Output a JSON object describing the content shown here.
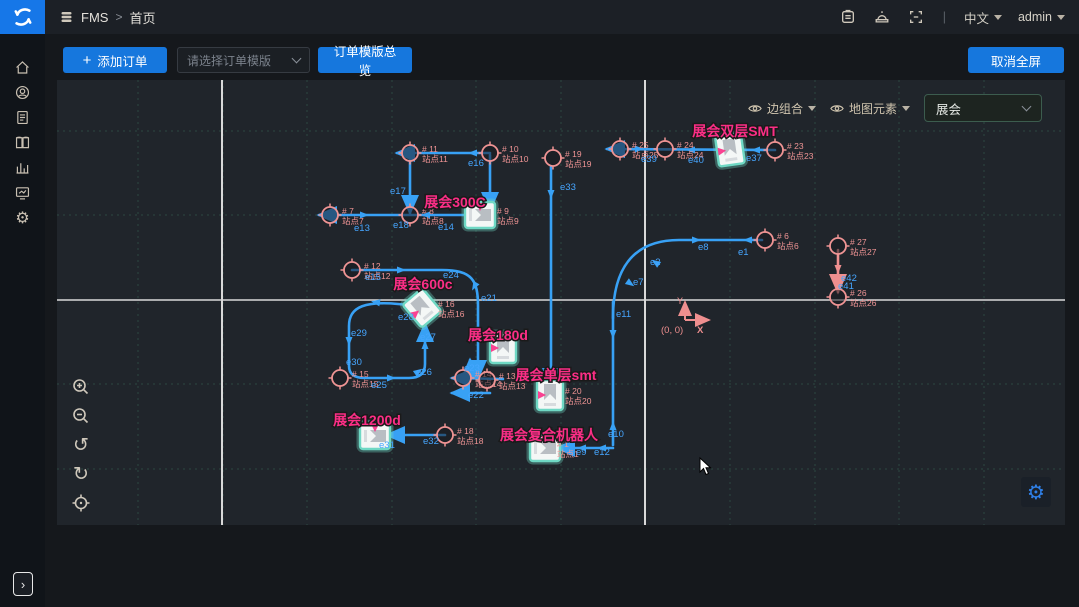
{
  "header": {
    "brand": "FMS",
    "breadcrumb_separator": ">",
    "page_title": "首页",
    "lang": "中文",
    "user": "admin"
  },
  "toolbar": {
    "add_order_icon": "+",
    "add_order": "添加订单",
    "template_placeholder": "请选择订单模版",
    "template_overview": "订单模版总览",
    "cancel_fullscreen": "取消全屏"
  },
  "sidebar_icons": [
    "home-icon",
    "robot-icon",
    "orders-icon",
    "map-icon",
    "stats-icon",
    "monitor-icon",
    "settings-icon"
  ],
  "header_icons": [
    "task-icon",
    "alarm-icon",
    "fullscreen-icon"
  ],
  "map": {
    "toolbar": {
      "edge_group": "边组合",
      "map_elements": "地图元素",
      "area_value": "展会"
    },
    "origin": {
      "label": "(0, 0)",
      "x_axis": "X",
      "y_axis": "Y"
    },
    "colors": {
      "edge": "#38a1f5",
      "edge_label": "#46a6ff",
      "station": "#ef9494",
      "area_label": "#fb2e86",
      "robot_stroke": "#6fd8c4",
      "pink_edge": "#ef8f8f",
      "grid": "#2b4740",
      "major": "#d9d9d9",
      "bg": "#20252b"
    },
    "grid": {
      "vx": [
        81,
        166,
        250,
        335,
        419,
        504,
        673,
        758,
        842,
        927
      ],
      "hy": [
        51,
        135,
        304,
        389
      ],
      "major_vx": [
        165,
        588
      ],
      "major_hy": [
        220
      ]
    },
    "paths": [
      {
        "d": "M433,73 L340,73",
        "end": true
      },
      {
        "d": "M353,73 L353,133",
        "end": true
      },
      {
        "d": "M433,75 L433,130",
        "end": true
      },
      {
        "d": "M423,135 L262,135",
        "end": true
      },
      {
        "d": "M718,70 L550,69",
        "end": true
      },
      {
        "d": "M494,86 L494,306",
        "end": true
      },
      {
        "d": "M556,222 L556,365",
        "end": false
      },
      {
        "d": "M556,238 C556,190 575,160 622,160 L705,160",
        "end": false
      },
      {
        "d": "M358,226 C305,218 292,228 292,246 L292,286 C292,296 300,298 308,298 L352,298 C364,298 368,292 368,284 L368,244",
        "end": true
      },
      {
        "d": "M295,190 L385,190 C415,190 421,200 421,226 L421,298",
        "end": true
      },
      {
        "d": "M446,299 L395,298",
        "end": true
      },
      {
        "d": "M433,313 L395,313",
        "end": true
      },
      {
        "d": "M413,298 L413,280",
        "end": true
      },
      {
        "d": "M388,355 L330,355",
        "end": true
      },
      {
        "d": "M556,368 L500,368",
        "end": true
      },
      {
        "d": "M781,170 L781,212",
        "end": true,
        "c": "pink"
      }
    ],
    "arrows": [
      {
        "x": 415,
        "y": 73,
        "r": 180
      },
      {
        "x": 308,
        "y": 135,
        "r": 0
      },
      {
        "x": 368,
        "y": 135,
        "r": 180
      },
      {
        "x": 583,
        "y": 69,
        "r": 0
      },
      {
        "x": 633,
        "y": 70,
        "r": 180
      },
      {
        "x": 698,
        "y": 70,
        "r": 180
      },
      {
        "x": 494,
        "y": 115,
        "r": 90
      },
      {
        "x": 556,
        "y": 255,
        "r": 90
      },
      {
        "x": 556,
        "y": 345,
        "r": 270
      },
      {
        "x": 640,
        "y": 160,
        "r": 0
      },
      {
        "x": 690,
        "y": 160,
        "r": 180
      },
      {
        "x": 598,
        "y": 182,
        "r": 215
      },
      {
        "x": 574,
        "y": 204,
        "r": 35
      },
      {
        "x": 318,
        "y": 222,
        "r": 190
      },
      {
        "x": 292,
        "y": 262,
        "r": 90
      },
      {
        "x": 335,
        "y": 298,
        "r": 0
      },
      {
        "x": 362,
        "y": 291,
        "r": 325
      },
      {
        "x": 368,
        "y": 264,
        "r": 270
      },
      {
        "x": 345,
        "y": 190,
        "r": 0
      },
      {
        "x": 417,
        "y": 207,
        "r": 120
      },
      {
        "x": 524,
        "y": 368,
        "r": 180
      },
      {
        "x": 544,
        "y": 368,
        "r": 180
      },
      {
        "x": 781,
        "y": 190,
        "r": 90,
        "c": "pink"
      }
    ],
    "stations": [
      {
        "tag": "# 11",
        "name": "站点11",
        "x": 353,
        "y": 73,
        "c": true
      },
      {
        "tag": "# 10",
        "name": "站点10",
        "x": 433,
        "y": 73,
        "c": true
      },
      {
        "tag": "# 19",
        "name": "站点19",
        "x": 496,
        "y": 78,
        "c": true
      },
      {
        "tag": "# 25",
        "name": "站点25",
        "x": 563,
        "y": 69,
        "c": true
      },
      {
        "tag": "# 24",
        "name": "站点24",
        "x": 608,
        "y": 69,
        "c": true
      },
      {
        "tag": "# 23",
        "name": "站点23",
        "x": 718,
        "y": 70,
        "c": true
      },
      {
        "tag": "# 7",
        "name": "站点7",
        "x": 273,
        "y": 135,
        "c": true
      },
      {
        "tag": "# 8",
        "name": "站点8",
        "x": 353,
        "y": 135,
        "c": true
      },
      {
        "tag": "# 12",
        "name": "站点12",
        "x": 295,
        "y": 190,
        "c": true
      },
      {
        "tag": "# 6",
        "name": "站点6",
        "x": 708,
        "y": 160,
        "c": true
      },
      {
        "tag": "# 27",
        "name": "站点27",
        "x": 781,
        "y": 166,
        "c": true
      },
      {
        "tag": "# 26",
        "name": "站点26",
        "x": 781,
        "y": 217,
        "c": true
      },
      {
        "tag": "# 15",
        "name": "站点15",
        "x": 283,
        "y": 298,
        "c": true
      },
      {
        "tag": "# 14",
        "name": "站点14",
        "x": 406,
        "y": 298,
        "c": true
      },
      {
        "tag": "# 13",
        "name": "站点13",
        "x": 430,
        "y": 300,
        "c": true
      },
      {
        "tag": "# 18",
        "name": "站点18",
        "x": 388,
        "y": 355,
        "c": true
      },
      {
        "tag": "# 9",
        "name": "站点9",
        "x": 423,
        "y": 135,
        "c": false,
        "lx": 440
      },
      {
        "tag": "# 16",
        "name": "站点16",
        "x": 365,
        "y": 228,
        "c": false,
        "lx": 381
      },
      {
        "tag": "# 20",
        "name": "站点20",
        "x": 493,
        "y": 315,
        "c": false,
        "lx": 508
      },
      {
        "tag": "# 1",
        "name": "站点1",
        "x": 488,
        "y": 368,
        "c": false,
        "lx": 500
      }
    ],
    "robots": [
      {
        "x": 673,
        "y": 70,
        "r": -8
      },
      {
        "x": 423,
        "y": 135,
        "r": 90
      },
      {
        "x": 365,
        "y": 228,
        "r": -40
      },
      {
        "x": 446,
        "y": 268,
        "r": 0
      },
      {
        "x": 493,
        "y": 315,
        "r": 0
      },
      {
        "x": 318,
        "y": 356,
        "r": 90
      },
      {
        "x": 488,
        "y": 368,
        "r": 90
      }
    ],
    "edge_labels": [
      {
        "t": "e16",
        "x": 411,
        "y": 86
      },
      {
        "t": "e17",
        "x": 333,
        "y": 114
      },
      {
        "t": "e33",
        "x": 503,
        "y": 110
      },
      {
        "t": "e13",
        "x": 297,
        "y": 151
      },
      {
        "t": "e18",
        "x": 336,
        "y": 148
      },
      {
        "t": "e14",
        "x": 381,
        "y": 150
      },
      {
        "t": "e39",
        "x": 584,
        "y": 82
      },
      {
        "t": "e40",
        "x": 631,
        "y": 83
      },
      {
        "t": "e37",
        "x": 689,
        "y": 81
      },
      {
        "t": "e1",
        "x": 681,
        "y": 175
      },
      {
        "t": "e8",
        "x": 641,
        "y": 170
      },
      {
        "t": "e2",
        "x": 593,
        "y": 185
      },
      {
        "t": "e7",
        "x": 576,
        "y": 205
      },
      {
        "t": "e11",
        "x": 559,
        "y": 237
      },
      {
        "t": "e10",
        "x": 551,
        "y": 357
      },
      {
        "t": "e9",
        "x": 519,
        "y": 375
      },
      {
        "t": "e12",
        "x": 537,
        "y": 375
      },
      {
        "t": "e15",
        "x": 308,
        "y": 200
      },
      {
        "t": "e24",
        "x": 386,
        "y": 198
      },
      {
        "t": "e21",
        "x": 424,
        "y": 221
      },
      {
        "t": "e28",
        "x": 341,
        "y": 240
      },
      {
        "t": "e29",
        "x": 294,
        "y": 256
      },
      {
        "t": "e30",
        "x": 289,
        "y": 285
      },
      {
        "t": "e25",
        "x": 314,
        "y": 308
      },
      {
        "t": "e26",
        "x": 359,
        "y": 295
      },
      {
        "t": "e27",
        "x": 363,
        "y": 260
      },
      {
        "t": "e23",
        "x": 407,
        "y": 291
      },
      {
        "t": "e22",
        "x": 411,
        "y": 318
      },
      {
        "t": "e32",
        "x": 366,
        "y": 364
      },
      {
        "t": "e31",
        "x": 322,
        "y": 368
      },
      {
        "t": "e42",
        "x": 784,
        "y": 201
      },
      {
        "t": "e41",
        "x": 781,
        "y": 209
      }
    ],
    "area_labels": [
      {
        "t": "展会双层SMT",
        "x": 678,
        "y": 56
      },
      {
        "t": "展会300C",
        "x": 398,
        "y": 127
      },
      {
        "t": "展会600c",
        "x": 366,
        "y": 209
      },
      {
        "t": "展会180d",
        "x": 441,
        "y": 260
      },
      {
        "t": "展会单层smt",
        "x": 499,
        "y": 300
      },
      {
        "t": "展会1200d",
        "x": 310,
        "y": 345
      },
      {
        "t": "展会复合机器人",
        "x": 492,
        "y": 360
      }
    ],
    "cursor": {
      "x": 643,
      "y": 378
    }
  }
}
